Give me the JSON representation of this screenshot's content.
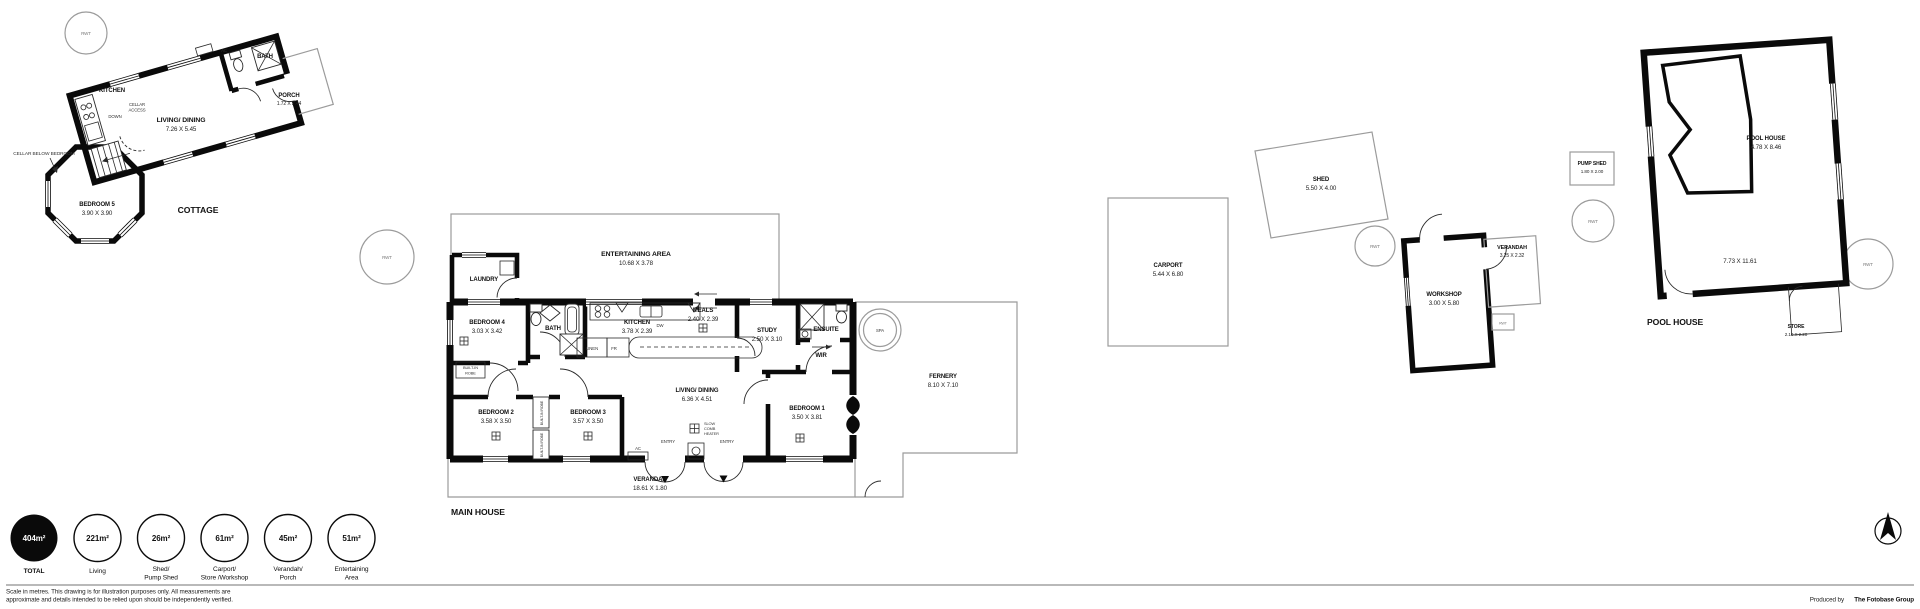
{
  "misc": {
    "rwt": "RWT",
    "spa": "SPA",
    "dw": "DW",
    "fr": "FR",
    "linen": "LINEN",
    "ac": "AC",
    "entry": "ENTRY",
    "down": "DOWN"
  },
  "cottage": {
    "title": "COTTAGE",
    "kitchen": "KITCHEN",
    "bath": "BATH",
    "living": {
      "name": "LIVING/ DINING",
      "dims": "7.26 X 5.45"
    },
    "porch": {
      "name": "PORCH",
      "dims": "1.72 X 2.44"
    },
    "bedroom5": {
      "name": "BEDROOM 5",
      "dims": "3.90 X 3.90"
    },
    "cellar_access_1": "CELLAR",
    "cellar_access_2": "ACCESS",
    "cellar_note": "CELLAR BELOW BEDROOM"
  },
  "main_house": {
    "title": "MAIN HOUSE",
    "entertaining": {
      "name": "ENTERTAINING AREA",
      "dims": "10.68 X 3.78"
    },
    "laundry": "LAUNDRY",
    "bedroom4": {
      "name": "BEDROOM 4",
      "dims": "3.03 X 3.42"
    },
    "bath": "BATH",
    "kitchen": {
      "name": "KITCHEN",
      "dims": "3.78 X 2.39"
    },
    "meals": {
      "name": "MEALS",
      "dims": "2.40 X 2.39"
    },
    "study": {
      "name": "STUDY",
      "dims": "2.50 X 3.10"
    },
    "ensuite": "ENSUITE",
    "wir": "WIR",
    "bedroom2": {
      "name": "BEDROOM 2",
      "dims": "3.58 X 3.50"
    },
    "bedroom3": {
      "name": "BEDROOM 3",
      "dims": "3.57 X 3.50"
    },
    "bedroom1": {
      "name": "BEDROOM 1",
      "dims": "3.50 X 3.81"
    },
    "living": {
      "name": "LIVING/ DINING",
      "dims": "6.36 X 4.51"
    },
    "robe_1": "BUILT-IN",
    "robe_2": "ROBE",
    "robe_vertical": "BUILT-IN ROBE",
    "heater_1": "SLOW",
    "heater_2": "COMB",
    "heater_3": "HEATER",
    "verandah": {
      "name": "VERANDAH",
      "dims": "18.61 X 1.80"
    },
    "fernery": {
      "name": "FERNERY",
      "dims": "8.10 X 7.10"
    }
  },
  "outbuildings": {
    "carport": {
      "name": "CARPORT",
      "dims": "5.44 X 6.80"
    },
    "shed": {
      "name": "SHED",
      "dims": "5.50 X 4.00"
    },
    "workshop": {
      "name": "WORKSHOP",
      "dims": "3.00 X 5.80"
    },
    "verandah": {
      "name": "VERANDAH",
      "dims": "3.25 X 2.32"
    },
    "pump_shed": {
      "name": "PUMP SHED",
      "dims": "1.80 X 2.00"
    }
  },
  "pool_house": {
    "title": "POOL HOUSE",
    "room": {
      "name": "POOL HOUSE",
      "dims": "4.78 X 8.46"
    },
    "overall_dims": "7.73 X 11.61",
    "store": {
      "name": "STORE",
      "dims": "2.10 X 2.20"
    }
  },
  "legend": {
    "items": [
      {
        "value": "404m²",
        "lines": [
          "TOTAL"
        ]
      },
      {
        "value": "221m²",
        "lines": [
          "Living"
        ]
      },
      {
        "value": "26m²",
        "lines": [
          "Shed/",
          "Pump Shed"
        ]
      },
      {
        "value": "61m²",
        "lines": [
          "Carport/",
          "Store /Workshop"
        ]
      },
      {
        "value": "45m²",
        "lines": [
          "Verandah/",
          "Porch"
        ]
      },
      {
        "value": "51m²",
        "lines": [
          "Entertaining",
          "Area"
        ]
      }
    ]
  },
  "footer": {
    "disclaimer_1": "Scale in metres. This drawing is for illustration purposes only. All measurements are",
    "disclaimer_2": "approximate and details intended to be relied upon should be independently verified.",
    "produced_by": "Produced by",
    "producer": "The Fotobase Group"
  }
}
